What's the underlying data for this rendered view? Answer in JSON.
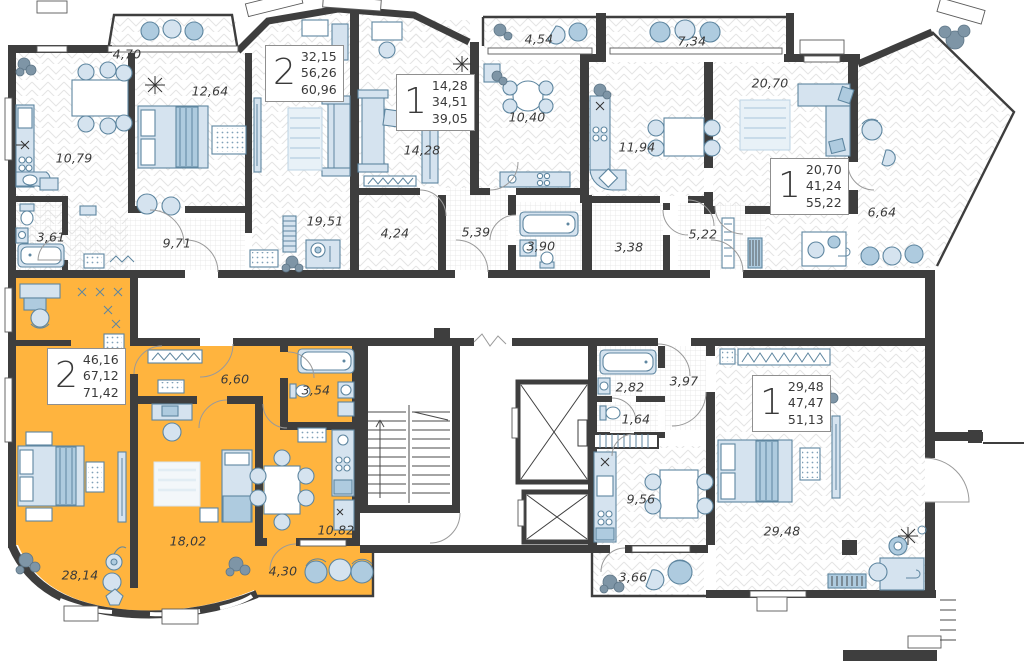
{
  "colors": {
    "highlight_apartment": "#FFB43E",
    "walls": "#3E3E3E",
    "furniture_fill": "#D5E3EF",
    "furniture_stroke": "#5E86A0",
    "hatch_line": "#E4E4E4"
  },
  "apartments": [
    {
      "id": "top-left",
      "rooms_count": "2",
      "areas": {
        "living": "32,15",
        "apartment": "56,26",
        "total": "60,96"
      },
      "highlighted": false
    },
    {
      "id": "top-middle",
      "rooms_count": "1",
      "areas": {
        "living": "14,28",
        "apartment": "34,51",
        "total": "39,05"
      },
      "highlighted": false
    },
    {
      "id": "top-right",
      "rooms_count": "1",
      "areas": {
        "living": "20,70",
        "apartment": "41,24",
        "total": "55,22"
      },
      "highlighted": false
    },
    {
      "id": "bottom-left",
      "rooms_count": "2",
      "areas": {
        "living": "46,16",
        "apartment": "67,12",
        "total": "71,42"
      },
      "highlighted": true
    },
    {
      "id": "bottom-right",
      "rooms_count": "1",
      "areas": {
        "living": "29,48",
        "apartment": "47,47",
        "total": "51,13"
      },
      "highlighted": false
    }
  ],
  "room_labels": [
    {
      "text": "4,70",
      "x": 127,
      "y": 54
    },
    {
      "text": "12,64",
      "x": 210,
      "y": 91
    },
    {
      "text": "10,79",
      "x": 74,
      "y": 158
    },
    {
      "text": "3,61",
      "x": 51,
      "y": 237
    },
    {
      "text": "9,71",
      "x": 177,
      "y": 243
    },
    {
      "text": "19,51",
      "x": 325,
      "y": 221
    },
    {
      "text": "14,28",
      "x": 422,
      "y": 150
    },
    {
      "text": "4,54",
      "x": 539,
      "y": 39
    },
    {
      "text": "10,40",
      "x": 527,
      "y": 117
    },
    {
      "text": "4,24",
      "x": 395,
      "y": 233
    },
    {
      "text": "5,39",
      "x": 476,
      "y": 232
    },
    {
      "text": "3,90",
      "x": 541,
      "y": 246
    },
    {
      "text": "7,34",
      "x": 692,
      "y": 41
    },
    {
      "text": "20,70",
      "x": 770,
      "y": 83
    },
    {
      "text": "11,94",
      "x": 637,
      "y": 147
    },
    {
      "text": "3,38",
      "x": 629,
      "y": 247
    },
    {
      "text": "5,22",
      "x": 703,
      "y": 234
    },
    {
      "text": "6,64",
      "x": 882,
      "y": 212
    },
    {
      "text": "6,60",
      "x": 235,
      "y": 379
    },
    {
      "text": "3,54",
      "x": 316,
      "y": 390
    },
    {
      "text": "28,14",
      "x": 80,
      "y": 575
    },
    {
      "text": "18,02",
      "x": 188,
      "y": 541
    },
    {
      "text": "10,82",
      "x": 336,
      "y": 530
    },
    {
      "text": "4,30",
      "x": 283,
      "y": 571
    },
    {
      "text": "2,82",
      "x": 630,
      "y": 387
    },
    {
      "text": "3,97",
      "x": 684,
      "y": 381
    },
    {
      "text": "1,64",
      "x": 636,
      "y": 419
    },
    {
      "text": "9,56",
      "x": 641,
      "y": 499
    },
    {
      "text": "3,66",
      "x": 633,
      "y": 577
    },
    {
      "text": "29,48",
      "x": 782,
      "y": 531
    }
  ]
}
